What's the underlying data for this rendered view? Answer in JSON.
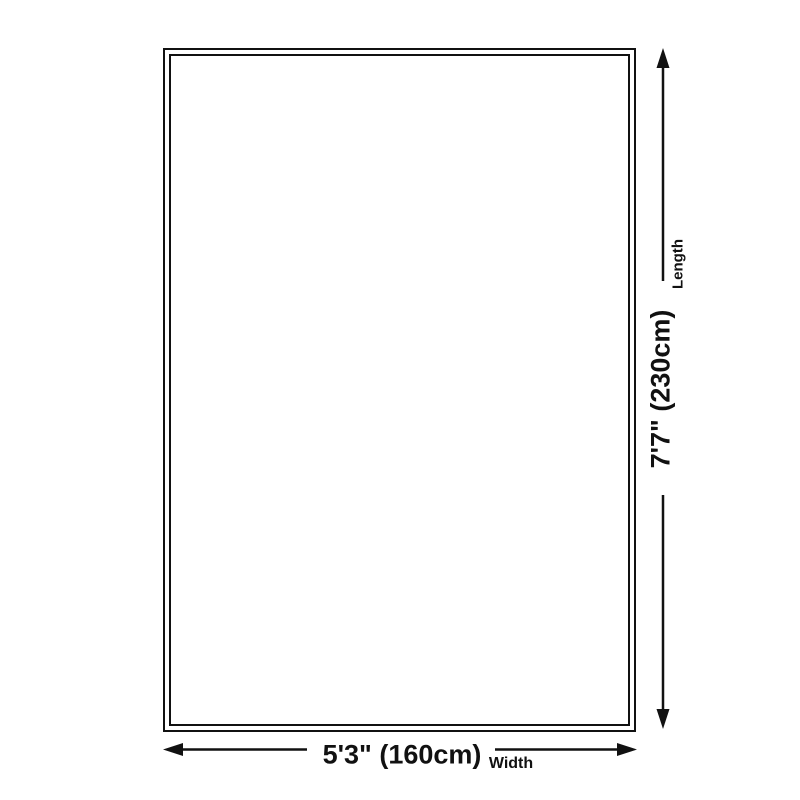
{
  "diagram": {
    "background_color": "#ffffff",
    "line_color": "#111111",
    "vertical_dimension": {
      "label": "Length",
      "value": "7'7\" (230cm)"
    },
    "horizontal_dimension": {
      "label": "Width",
      "value": "5'3\" (160cm)"
    }
  }
}
